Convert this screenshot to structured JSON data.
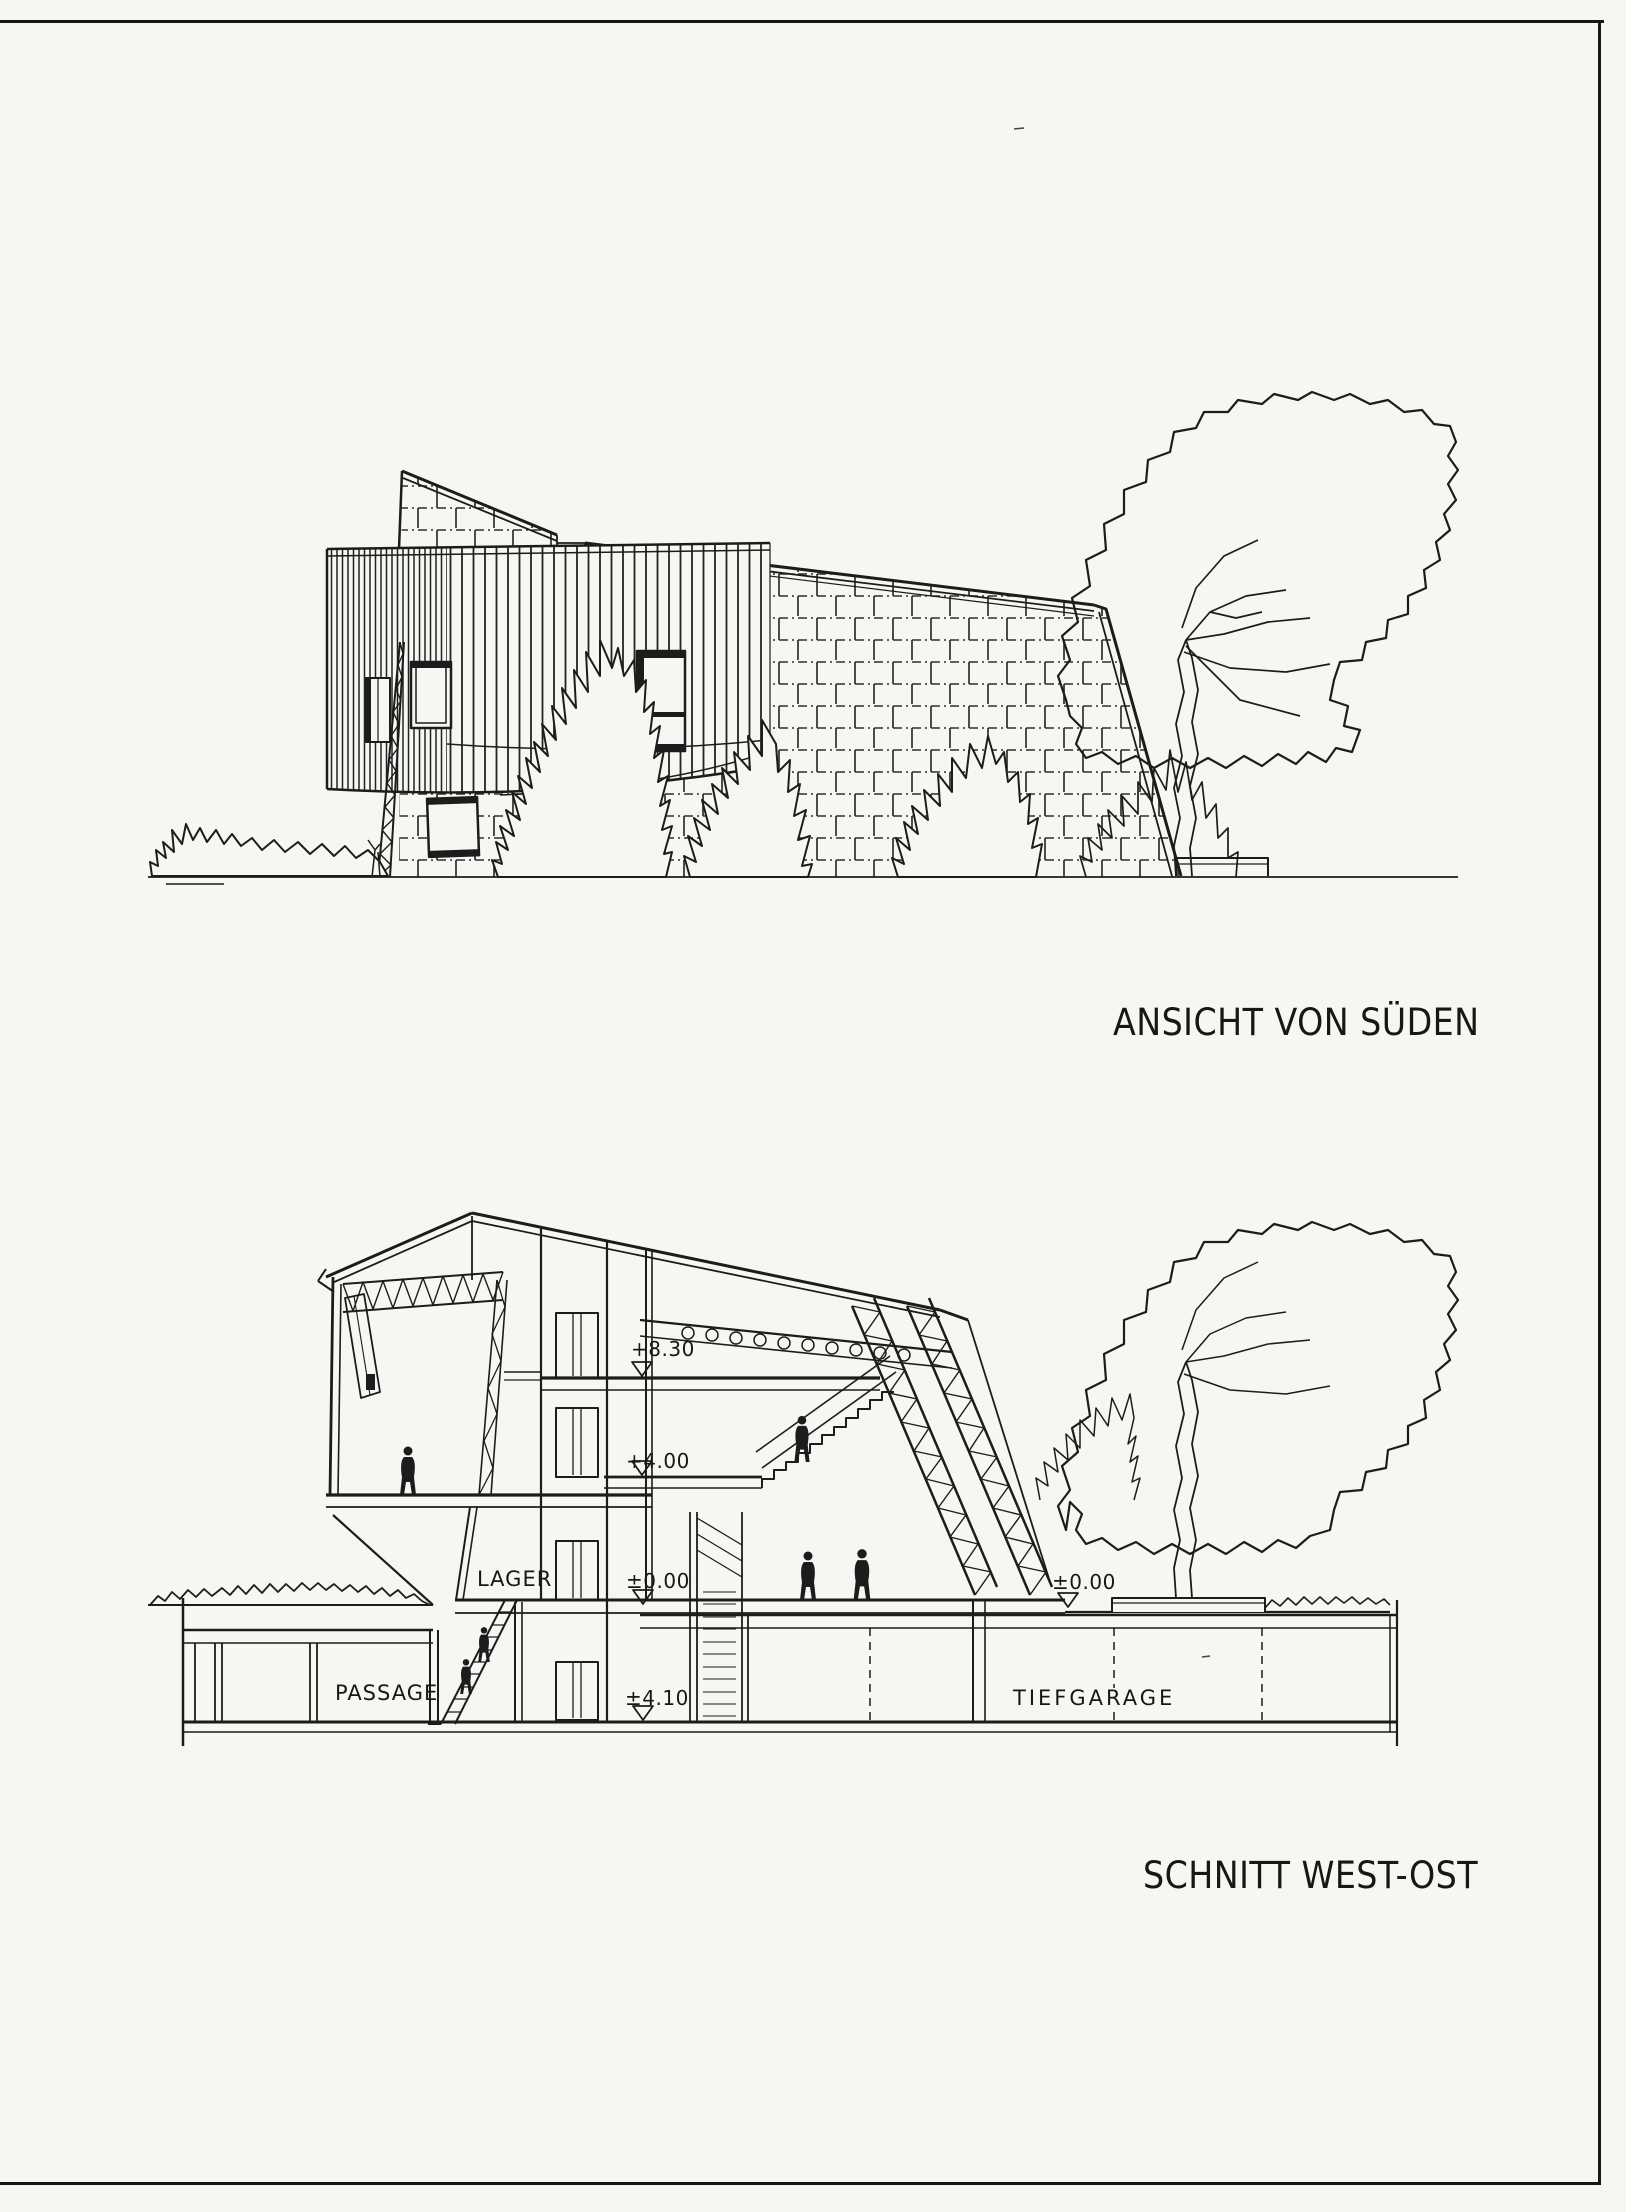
{
  "sheet": {
    "background": "#f7f6f2",
    "ink": "#1c1c1c",
    "frame_color": "#161616"
  },
  "elevation": {
    "caption": "ANSICHT VON SÜDEN"
  },
  "section": {
    "caption": "SCHNITT WEST-OST",
    "room_labels": {
      "lager": "LAGER",
      "passage": "PASSAGE",
      "tiefgarage": "TIEFGARAGE"
    },
    "level_markers": {
      "plus_830": "+8.30",
      "plus_400": "+4.00",
      "zero_left": "±0.00",
      "minus_410": "±4.10",
      "zero_right": "±0.00"
    }
  }
}
